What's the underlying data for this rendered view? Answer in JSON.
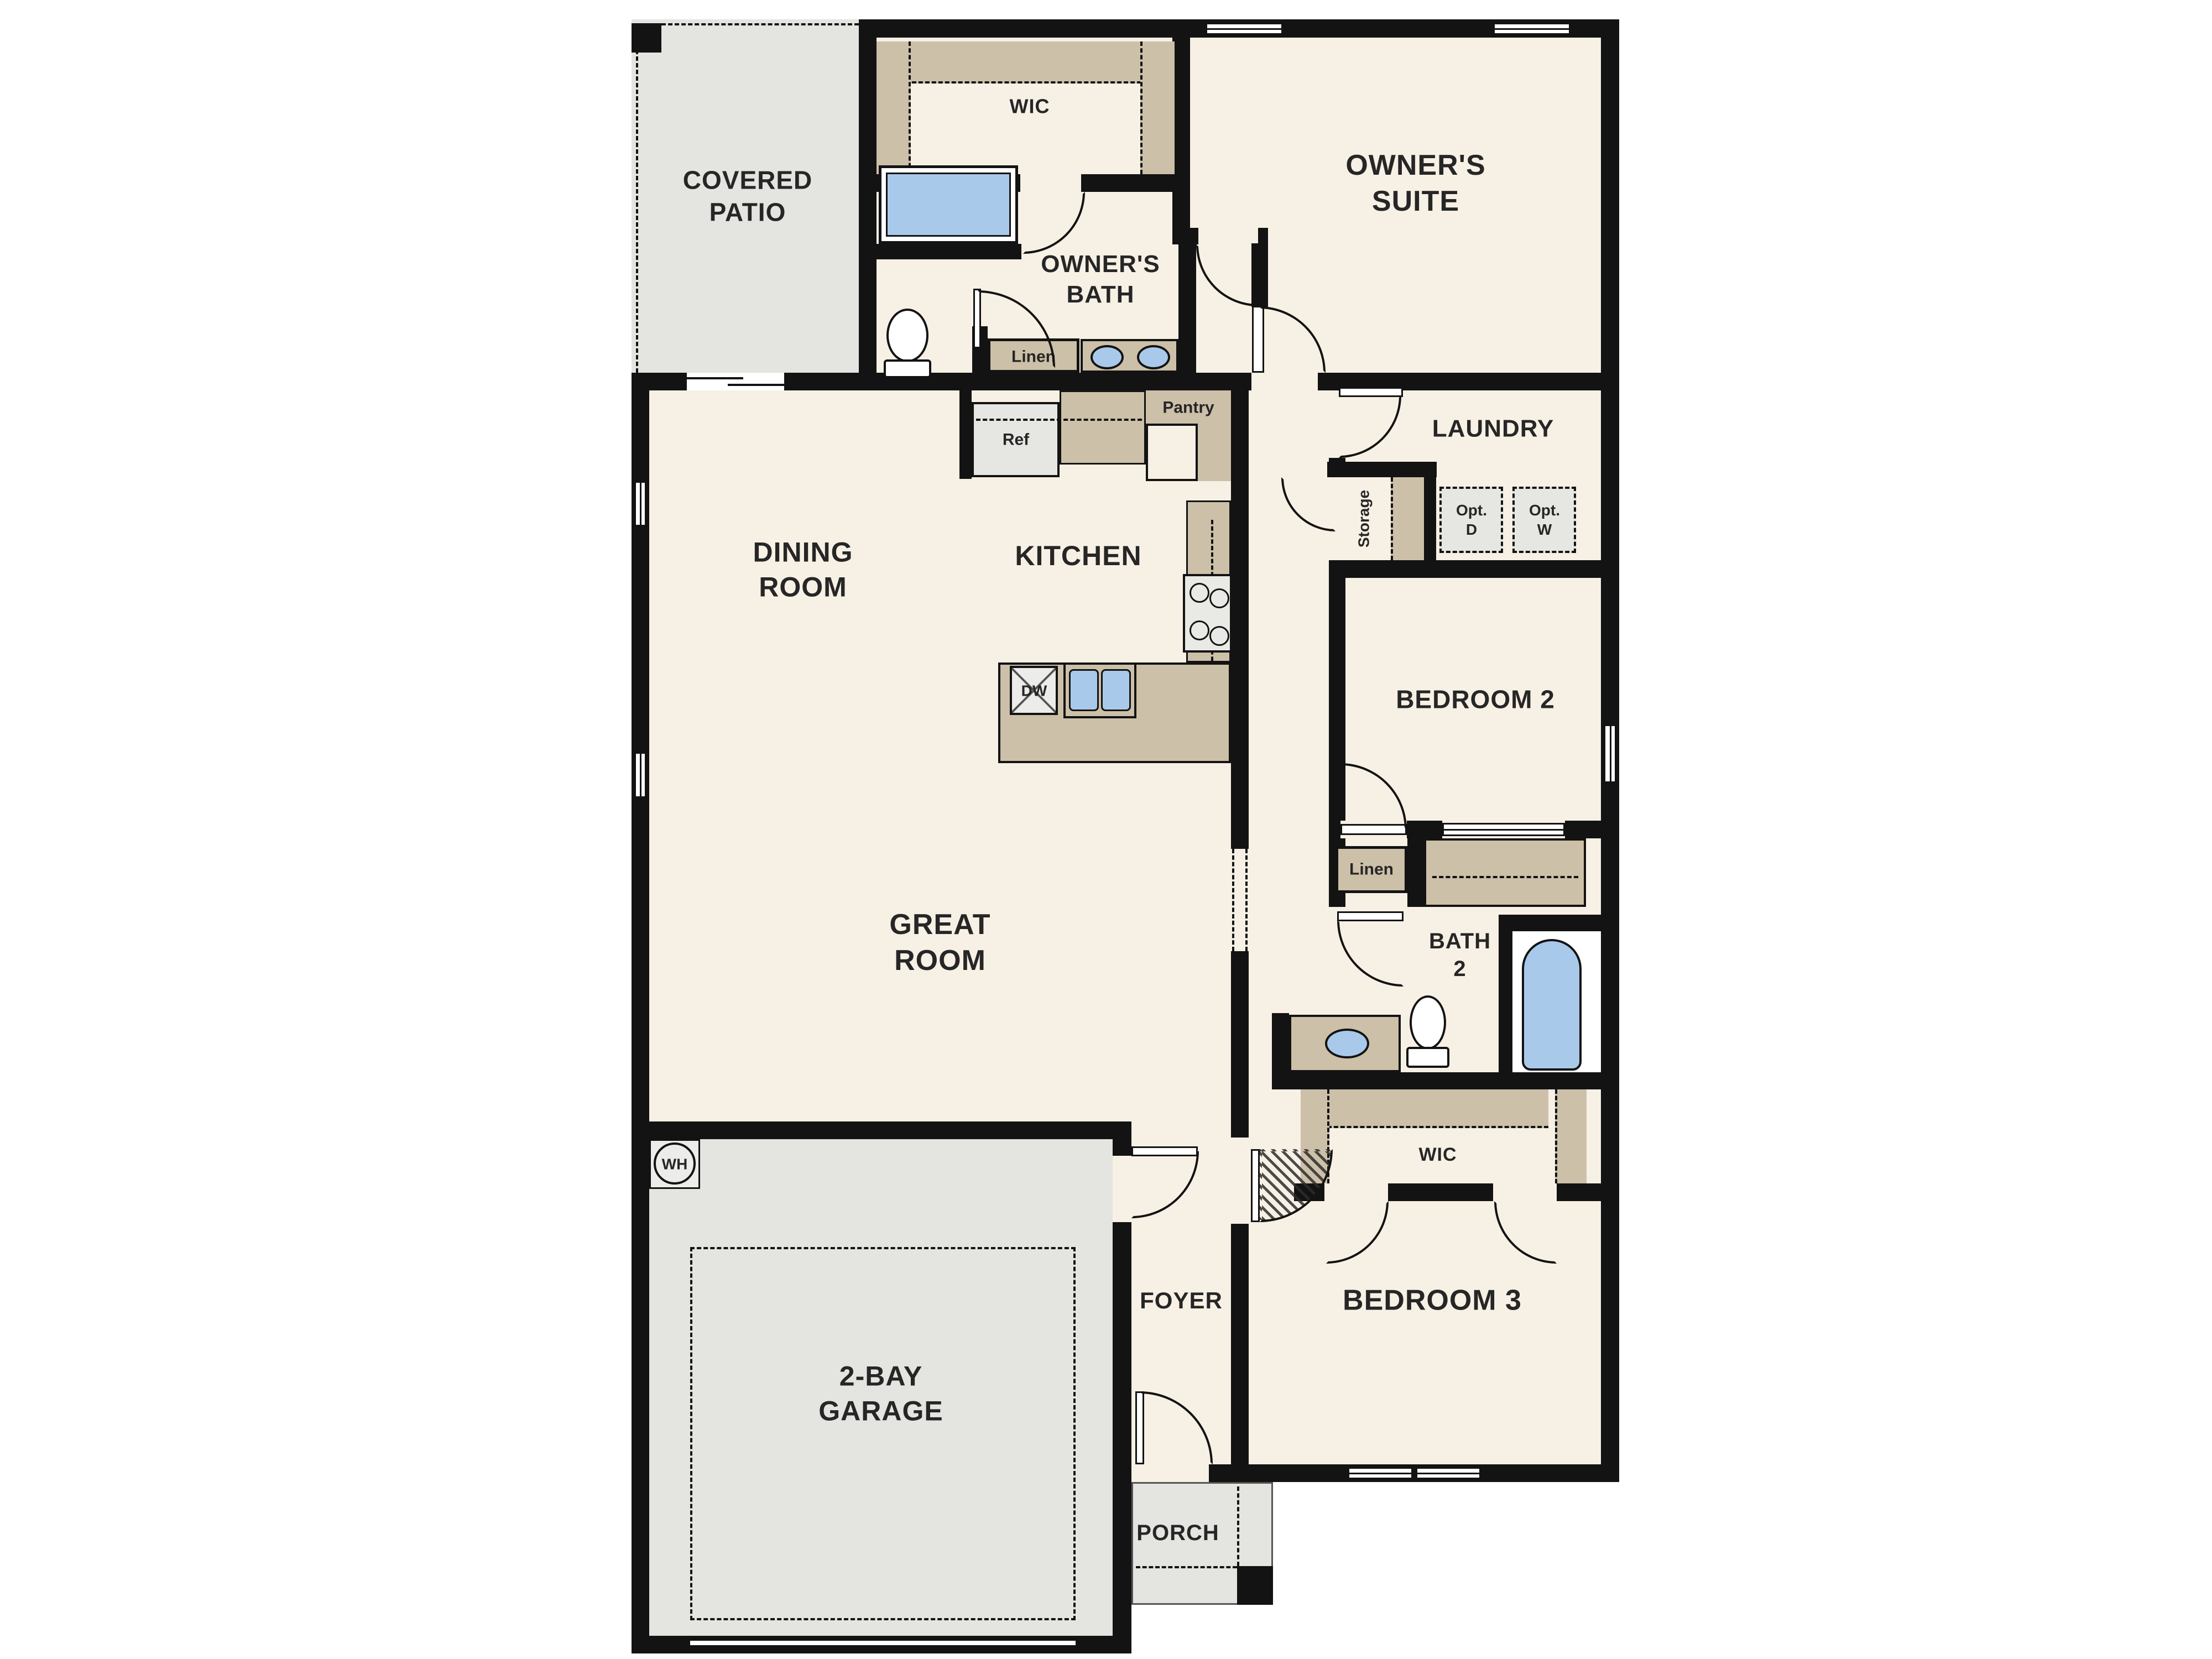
{
  "title": "Single-story 3-bedroom floor plan",
  "colors": {
    "wall": "#131313",
    "floor": "#f7f0e5",
    "gray": "#e4e4e1",
    "tan": "#ccc0a8",
    "blue": "#a9c9ea",
    "ink": "#262626",
    "page": "#ffffff"
  },
  "labels": {
    "patio1": "COVERED",
    "patio2": "PATIO",
    "wic_owner": "WIC",
    "obath1": "OWNER'S",
    "obath2": "BATH",
    "osuite1": "OWNER'S",
    "osuite2": "SUITE",
    "linen_bath": "Linen",
    "ref": "Ref",
    "pantry": "Pantry",
    "kitchen": "KITCHEN",
    "dining1": "DINING",
    "dining2": "ROOM",
    "laundry": "LAUNDRY",
    "storage": "Storage",
    "optd1": "Opt.",
    "optd2": "D",
    "optw1": "Opt.",
    "optw2": "W",
    "bedroom2": "BEDROOM 2",
    "linen_hall": "Linen",
    "bath2a": "BATH",
    "bath2b": "2",
    "wic_bed3": "WIC",
    "great1": "GREAT",
    "great2": "ROOM",
    "foyer": "FOYER",
    "bedroom3": "BEDROOM 3",
    "garage1": "2-BAY",
    "garage2": "GARAGE",
    "porch": "PORCH",
    "wh": "WH",
    "dw": "DW"
  }
}
